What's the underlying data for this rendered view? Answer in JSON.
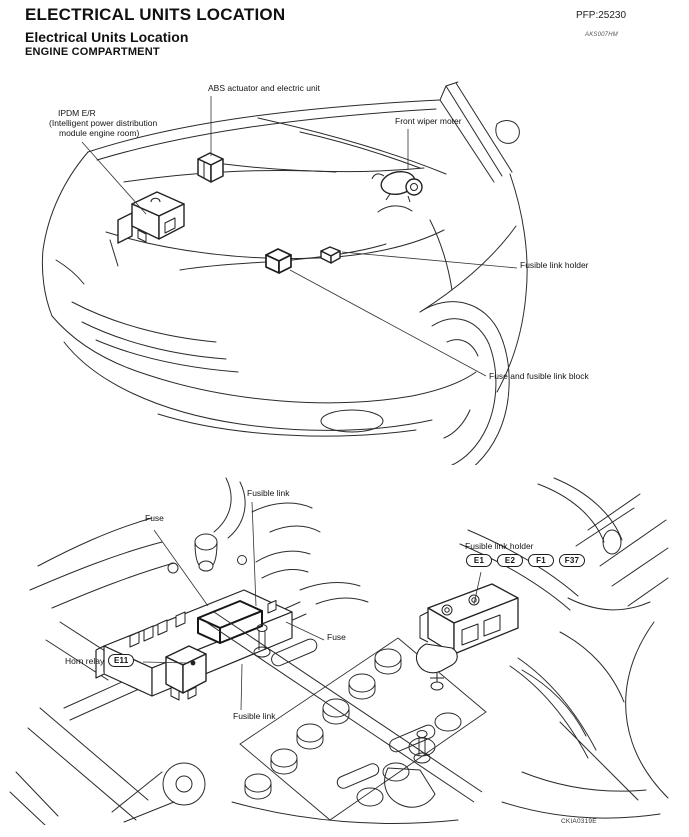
{
  "page": {
    "title": "ELECTRICAL UNITS LOCATION",
    "pfp_code": "PFP:25230",
    "subtitle": "Electrical Units Location",
    "subtitle_ref_code": "AKS007HM",
    "section_heading": "ENGINE COMPARTMENT",
    "figure_ref_code": "CKIA0319E"
  },
  "figure_top": {
    "description": "Engine compartment overview line drawing (front of vehicle, hood open)",
    "labels": {
      "abs": "ABS actuator and electric unit",
      "ipdm_line1": "IPDM E/R",
      "ipdm_line2": "(Intelligent power distribution",
      "ipdm_line3": "module engine room)",
      "wiper": "Front wiper moter",
      "fusible_link_holder": "Fusible link holder",
      "fuse_block": "Fuse and fusible link block"
    }
  },
  "figure_bottom": {
    "description": "Battery and fuse box area close-up line drawing",
    "labels": {
      "fusible_link_top": "Fusible link",
      "fuse_left": "Fuse",
      "fusible_link_holder": "Fusible link holder",
      "fuse_mid": "Fuse",
      "horn_relay": "Horn relay",
      "fusible_link_bottom": "Fusible link"
    },
    "connectors": [
      "E1",
      "E2",
      "F1",
      "F37"
    ],
    "horn_relay_connector": "E11"
  }
}
